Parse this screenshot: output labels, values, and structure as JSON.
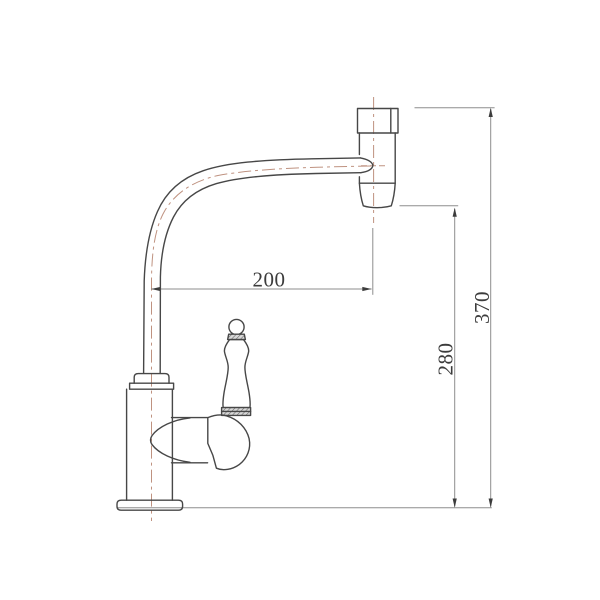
{
  "drawing": {
    "subject": "Kitchen faucet side-view technical drawing",
    "units": "mm"
  },
  "dimensions": {
    "spout_reach": {
      "value": "200",
      "orientation": "horizontal"
    },
    "outlet_height": {
      "value": "280",
      "orientation": "vertical"
    },
    "overall_height": {
      "value": "370",
      "orientation": "vertical"
    }
  },
  "colors": {
    "background": "#ffffff",
    "outline": "#474747",
    "centerline": "#bf9280",
    "dimension": "#8d8d8d",
    "text": "#3c3c3c"
  }
}
